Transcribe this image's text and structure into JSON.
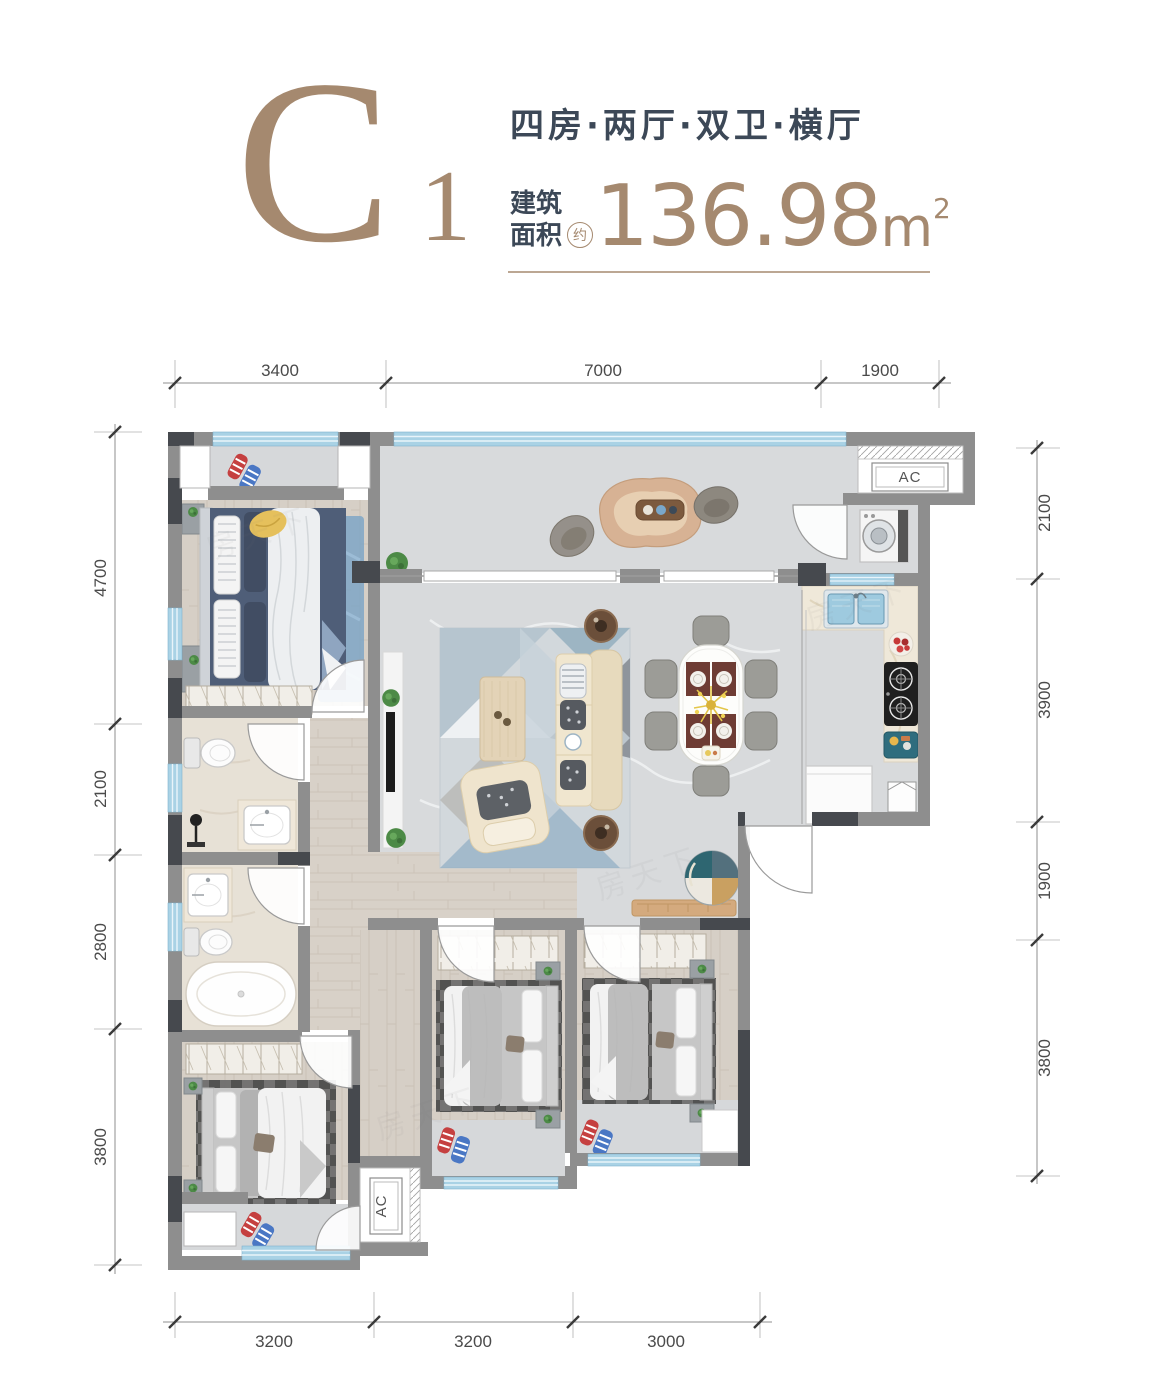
{
  "header": {
    "plan_code": "C",
    "plan_code_sub": "1",
    "tagline": "四房·两厅·双卫·横厅",
    "area_label_line1": "建筑",
    "area_label_line2": "面积",
    "area_approx": "约",
    "area_value": "136.98",
    "area_unit": "m",
    "area_unit_sup": "2"
  },
  "dims": {
    "top": [
      "3400",
      "7000",
      "1900"
    ],
    "left": [
      "4700",
      "2100",
      "2800",
      "3800"
    ],
    "right": [
      "2100",
      "3900",
      "1900",
      "3800"
    ],
    "bottom": [
      "3200",
      "3200",
      "3000"
    ]
  },
  "plan": {
    "ac_label": "AC"
  },
  "watermark": {
    "text": "房天下"
  },
  "colors": {
    "accent_taupe": "#a5896f",
    "navy_text": "#3c4857",
    "wall_gray": "#8e8e8e",
    "wall_dark": "#46494e",
    "window_blue": "#a9d2e5",
    "marble_floor": "#dadcde",
    "wood_floor": "#d6cfc6",
    "tile_floor": "#e7e1d6",
    "bed_navy": "#4f5e78",
    "sofa_beige": "#eee3cc"
  }
}
